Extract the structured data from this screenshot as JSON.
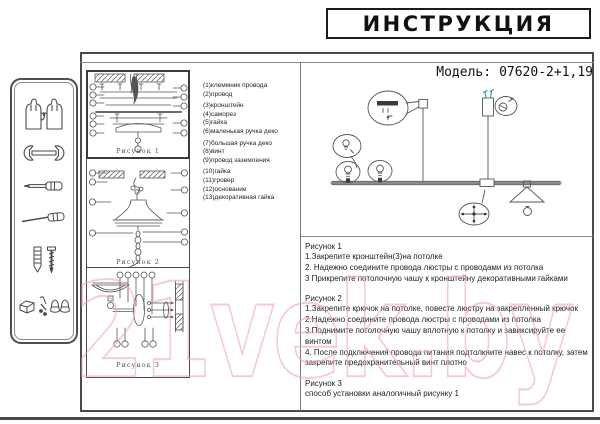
{
  "title": "ИНСТРУКЦИЯ",
  "model": {
    "label": "Модель:",
    "value": "07620-2+1,19"
  },
  "watermark": "21vek.by",
  "parts_list": [
    {
      "num": "(1)",
      "name": "клеммник провода"
    },
    {
      "num": "(2)",
      "name": "провод"
    },
    {
      "num": "(3)",
      "name": "кронштейн"
    },
    {
      "num": "(4)",
      "name": "саморез"
    },
    {
      "num": "(5)",
      "name": "гайка"
    },
    {
      "num": "(6)",
      "name": "маленькая ручка деко"
    },
    {
      "num": "(7)",
      "name": "большая ручка деко"
    },
    {
      "num": "(8)",
      "name": "винт"
    },
    {
      "num": "(9)",
      "name": "провод заземления"
    },
    {
      "num": "(10)",
      "name": "гайка"
    },
    {
      "num": "(11)",
      "name": "гровер"
    },
    {
      "num": "(12)",
      "name": "основание"
    },
    {
      "num": "(13)",
      "name": "декоративная гайка"
    }
  ],
  "figures": [
    {
      "label": "Рисунок 1"
    },
    {
      "label": "Рисунок 2"
    },
    {
      "label": "Рисунок 3"
    }
  ],
  "instructions": [
    {
      "heading": "Рисунок 1",
      "steps": [
        "1.Закрепите кронштейн(3)на потолке",
        "2. Надежно соедините провода люстры с проводами из потолка",
        "3 Прикрепите потолочную чашу к кронштейну декоративными гайками"
      ]
    },
    {
      "heading": "Рисунок 2",
      "steps": [
        "1.Закрепите крючок на потолке, повесте люстру на закрепленный крючок",
        "2.Надежно соедините провода люстры с проводами из потолка",
        "3.Поднимите потолочную чашу вплотную к потолку и завиксируйте ее винтом",
        "4. После подключения провода питания подтолкните навес к потолку, затем закрепите предохранительный винт плотно"
      ]
    },
    {
      "heading": "Рисунок 3",
      "steps": [
        "способ установки аналогичный рисунку 1"
      ]
    }
  ],
  "sidebar": {
    "tools": [
      "gloves",
      "wrench",
      "screwdriver",
      "awl",
      "wall plug and screw",
      "mounting hardware"
    ]
  },
  "colors": {
    "line": "#555555",
    "ink": "#1c1c1c",
    "watermark_pink": "#f1a0b4",
    "teal": "#2e9aa8"
  }
}
